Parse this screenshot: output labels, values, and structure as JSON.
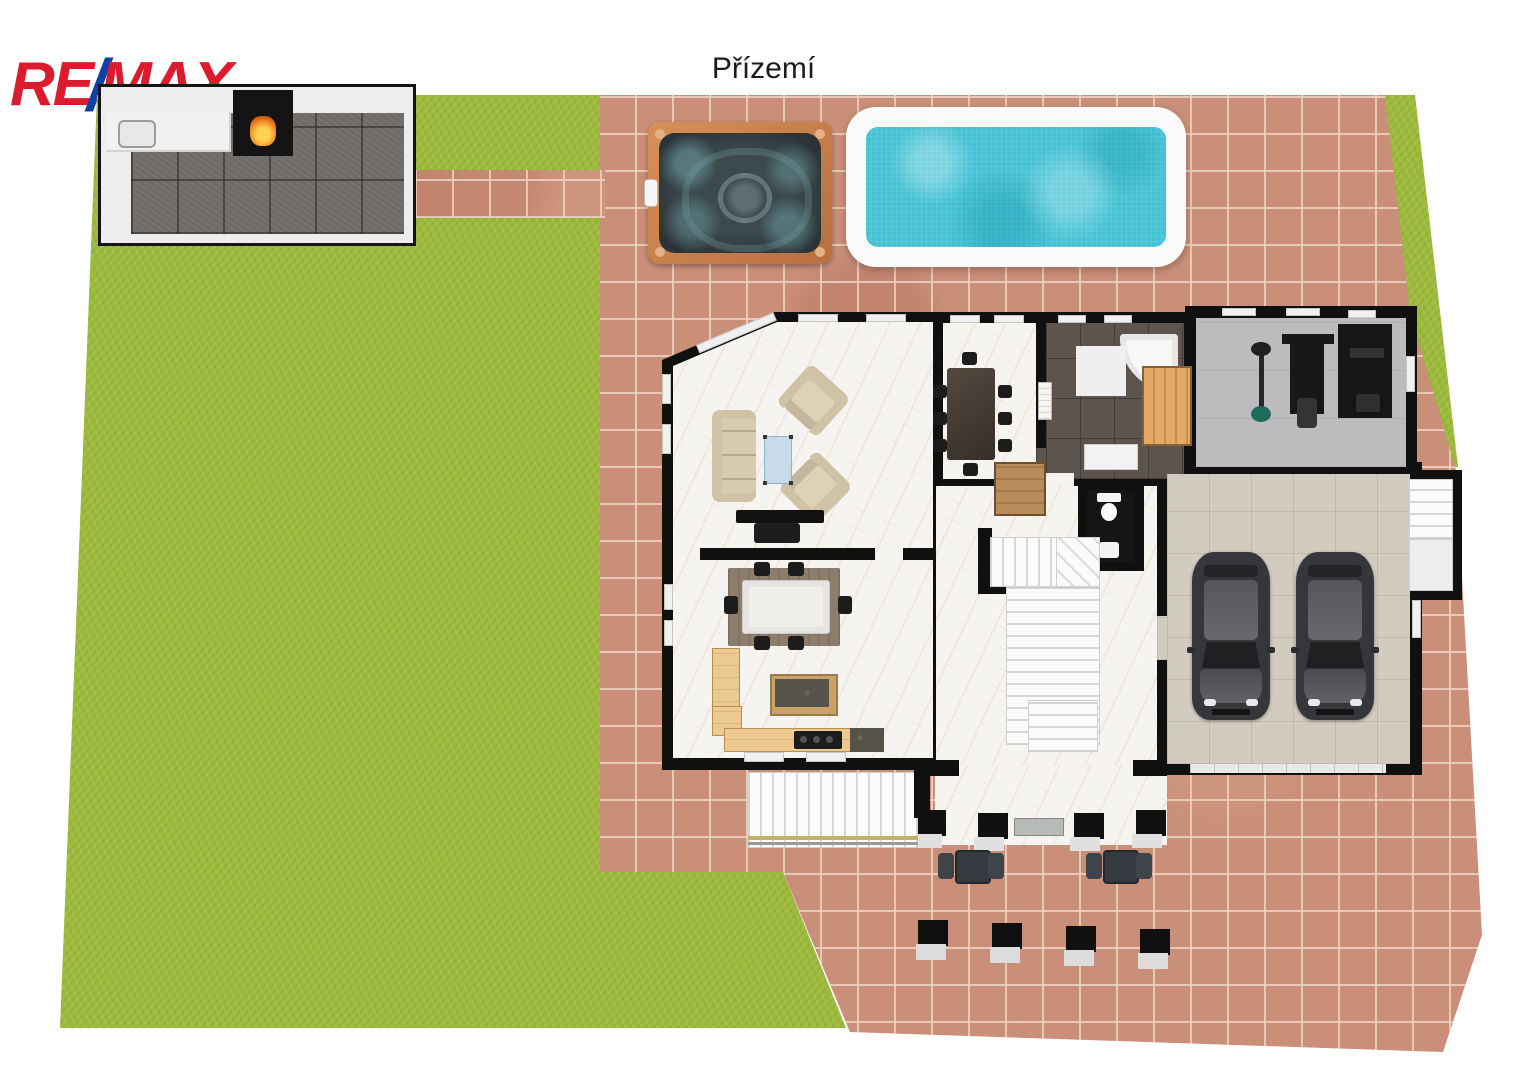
{
  "header": {
    "title": "Přízemí"
  },
  "logo": {
    "re": "RE",
    "slash": "/",
    "max": "MAX"
  },
  "palette": {
    "remax_red": "#dc1c2e",
    "remax_blue": "#1041a5",
    "lawn_green": "#9cba3b",
    "paving_terracotta": "#c98f79",
    "patio_tile_gray": "#6f6b69",
    "pool_water_turquoise": "#45c2d4",
    "pool_rim_white": "#fafafa",
    "hot_tub_copper": "#c87f4e",
    "wall_black": "#101010",
    "marble_white": "#f6f4f0",
    "bathroom_tile_brown": "#5d554d",
    "gym_floor_gray": "#bcbcbe",
    "garage_floor_beige": "#d2ccc0",
    "kitchen_wood": "#ecc98f",
    "sofa_beige": "#d8cbb0"
  },
  "scene": {
    "cars_in_garage": 2,
    "outdoor_bistro_sets": 2,
    "porch_pillars": 4
  }
}
